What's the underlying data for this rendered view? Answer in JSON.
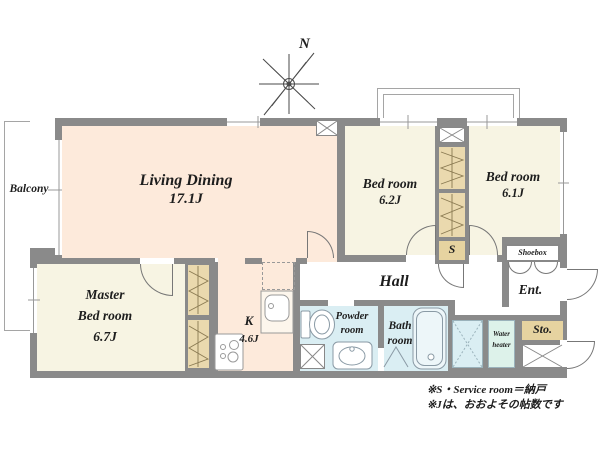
{
  "compass": {
    "label": "N"
  },
  "rooms": {
    "balcony": {
      "label": "Balcony"
    },
    "living_dining": {
      "label": "Living Dining",
      "size": "17.1J"
    },
    "bedroom_1": {
      "label": "Bed room",
      "size": "6.2J"
    },
    "bedroom_2": {
      "label": "Bed room",
      "size": "6.1J"
    },
    "master_bedroom": {
      "label_line1": "Master",
      "label_line2": "Bed room",
      "size": "6.7J"
    },
    "kitchen": {
      "label": "K",
      "size": "4.6J"
    },
    "hall": {
      "label": "Hall"
    },
    "powder_room": {
      "label_line1": "Powder",
      "label_line2": "room"
    },
    "bath_room": {
      "label_line1": "Bath",
      "label_line2": "room"
    },
    "entrance": {
      "label": "Ent."
    },
    "storage": {
      "label": "Sto."
    },
    "water_heater": {
      "label_line1": "Water",
      "label_line2": "heater"
    },
    "shoebox": {
      "label": "Shoebox"
    },
    "service_room": {
      "label": "S"
    }
  },
  "notes": {
    "line1": "※S・Service room＝納戸",
    "line2": "※Jは、おおよその帖数です"
  },
  "colors": {
    "wall": "#8a8a8a",
    "living_dining": "#fdeadb",
    "bedroom": "#f7f4e3",
    "wet_area": "#daeef3",
    "closet": "#ead9ae",
    "service": "#e6d3a0",
    "water_heater": "#ddf2ea",
    "line": "#999999"
  }
}
